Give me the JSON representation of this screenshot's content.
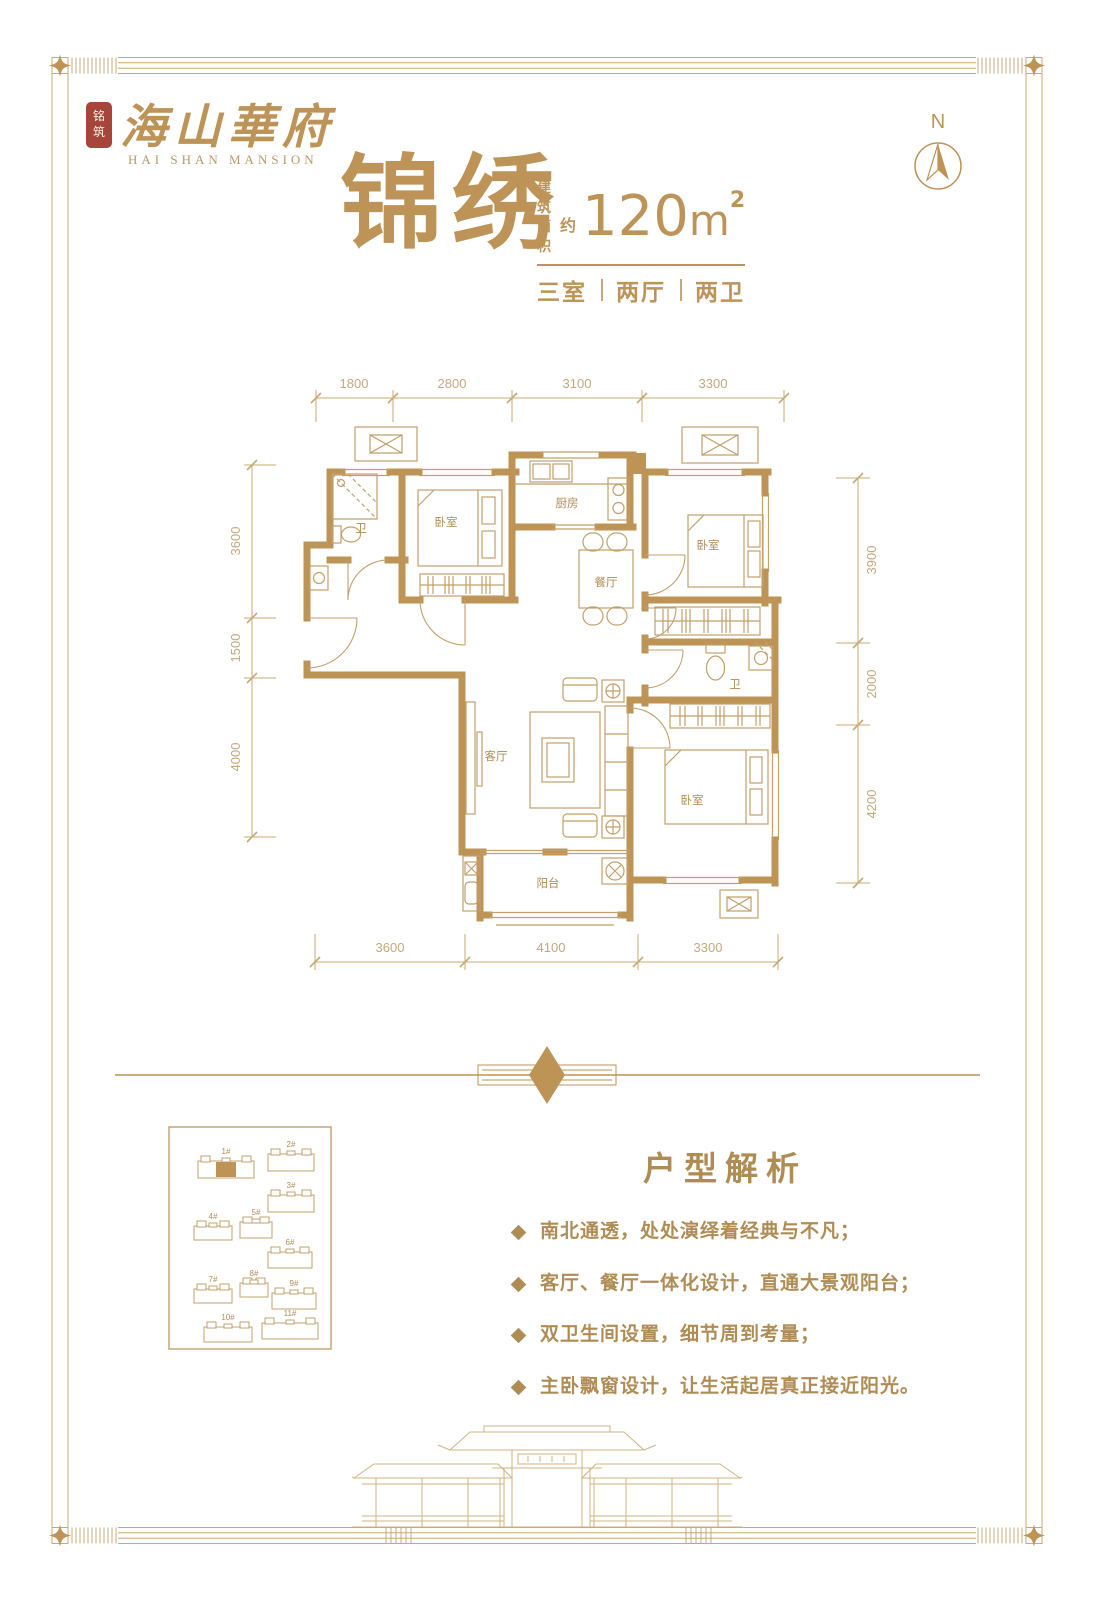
{
  "brand": {
    "seal_line1": "铭",
    "seal_line2": "筑",
    "name": "海山華府",
    "name_en": "HAI SHAN MANSION"
  },
  "compass": {
    "label": "N"
  },
  "unit": {
    "name": "锦绣",
    "area_prefix_line1": "建筑",
    "area_prefix_line2": "面积",
    "approx": "约",
    "area_value": "120",
    "area_unit": "m",
    "area_sup": "2",
    "layout_parts": [
      "三室",
      "两厅",
      "两卫"
    ]
  },
  "floor_plan": {
    "rooms": [
      {
        "label": "卧室",
        "cx": 216,
        "cy": 176
      },
      {
        "label": "厨房",
        "cx": 337,
        "cy": 157
      },
      {
        "label": "餐厅",
        "cx": 376,
        "cy": 236
      },
      {
        "label": "卧室",
        "cx": 478,
        "cy": 199
      },
      {
        "label": "卫",
        "cx": 131,
        "cy": 182
      },
      {
        "label": "卫",
        "cx": 505,
        "cy": 338
      },
      {
        "label": "客厅",
        "cx": 266,
        "cy": 410
      },
      {
        "label": "阳台",
        "cx": 318,
        "cy": 537
      },
      {
        "label": "卧室",
        "cx": 462,
        "cy": 454
      }
    ],
    "dims_top": [
      {
        "v": "1800",
        "x": 124
      },
      {
        "v": "2800",
        "x": 222
      },
      {
        "v": "3100",
        "x": 347
      },
      {
        "v": "3300",
        "x": 483
      }
    ],
    "dims_bottom": [
      {
        "v": "3600",
        "x": 160
      },
      {
        "v": "4100",
        "x": 321
      },
      {
        "v": "3300",
        "x": 478
      }
    ],
    "dims_left": [
      {
        "v": "3600",
        "y": 191
      },
      {
        "v": "1500",
        "y": 298
      },
      {
        "v": "4000",
        "y": 407
      }
    ],
    "dims_right": [
      {
        "v": "3900",
        "y": 210
      },
      {
        "v": "2000",
        "y": 334
      },
      {
        "v": "4200",
        "y": 454
      }
    ]
  },
  "site_plan": {
    "buildings": [
      {
        "label": "1#",
        "x": 30,
        "y": 30,
        "w": 56,
        "h": 22,
        "highlight": true
      },
      {
        "label": "2#",
        "x": 100,
        "y": 23,
        "w": 46,
        "h": 22,
        "highlight": false
      },
      {
        "label": "3#",
        "x": 100,
        "y": 64,
        "w": 46,
        "h": 22,
        "highlight": false
      },
      {
        "label": "4#",
        "x": 26,
        "y": 95,
        "w": 38,
        "h": 19,
        "highlight": false
      },
      {
        "label": "5#",
        "x": 72,
        "y": 91,
        "w": 32,
        "h": 21,
        "highlight": false
      },
      {
        "label": "6#",
        "x": 100,
        "y": 121,
        "w": 44,
        "h": 21,
        "highlight": false
      },
      {
        "label": "7#",
        "x": 26,
        "y": 158,
        "w": 38,
        "h": 19,
        "highlight": false
      },
      {
        "label": "8#",
        "x": 72,
        "y": 152,
        "w": 28,
        "h": 19,
        "highlight": false
      },
      {
        "label": "9#",
        "x": 104,
        "y": 162,
        "w": 44,
        "h": 21,
        "highlight": false
      },
      {
        "label": "10#",
        "x": 36,
        "y": 196,
        "w": 48,
        "h": 20,
        "highlight": false
      },
      {
        "label": "11#",
        "x": 94,
        "y": 192,
        "w": 56,
        "h": 21,
        "highlight": false
      }
    ]
  },
  "analysis": {
    "title": "户型解析",
    "bullets": [
      "南北通透，处处演绎着经典与不凡；",
      "客厅、餐厅一体化设计，直通大景观阳台；",
      "双卫生间设置，细节周到考量；",
      "主卧飘窗设计，让生活起居真正接近阳光。"
    ]
  },
  "colors": {
    "wall_gold": "#be9356",
    "line_gold": "#c8a873",
    "text_gold": "#b08c55",
    "title_gold": "#bd9357",
    "seal_red": "#a8453a"
  }
}
